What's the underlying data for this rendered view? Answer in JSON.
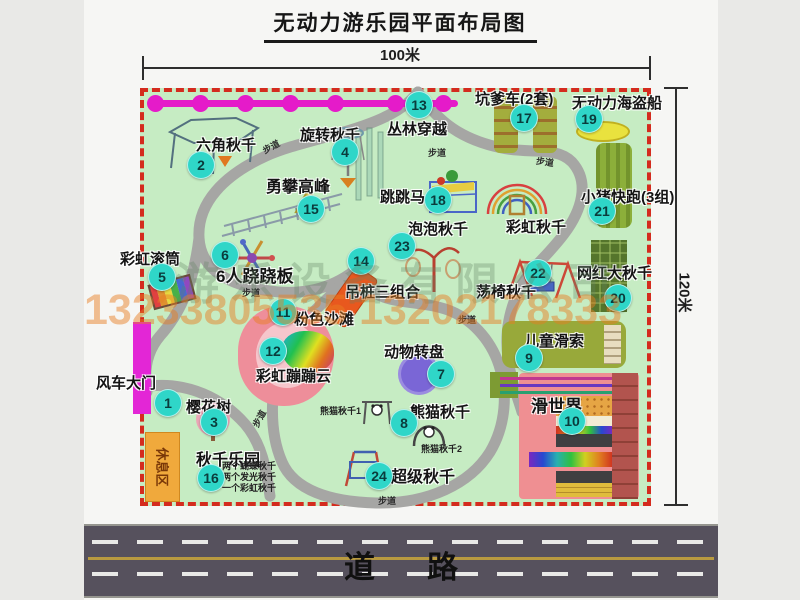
{
  "title": "无动力游乐园平面布局图",
  "dimensions": {
    "top": "100米",
    "right": "120米"
  },
  "road": {
    "label": "道路"
  },
  "watermark": {
    "company": "游乐设备有限公司",
    "phones": "13233805535 13202178333"
  },
  "park": {
    "rest_area_label": "休息区",
    "path_label": "步道",
    "rainbow_swing_label": "彩虹秋千",
    "panda_swing_1": "熊猫秋千1",
    "panda_swing_2": "熊猫秋千2",
    "swing_park_notes": [
      "两个蝴蝶秋千",
      "两个发光秋千",
      "一个彩虹秋千"
    ]
  },
  "items": [
    {
      "num": "1",
      "label": "风车大门"
    },
    {
      "num": "2",
      "label": "六角秋千"
    },
    {
      "num": "3",
      "label": "樱花树"
    },
    {
      "num": "4",
      "label": "旋转秋千"
    },
    {
      "num": "5",
      "label": "彩虹滚筒"
    },
    {
      "num": "6",
      "label": "6人跷跷板"
    },
    {
      "num": "7",
      "label": "动物转盘"
    },
    {
      "num": "8",
      "label": "熊猫秋千"
    },
    {
      "num": "9",
      "label": "儿童滑索"
    },
    {
      "num": "10",
      "label": "滑世界"
    },
    {
      "num": "11",
      "label": "粉色沙滩"
    },
    {
      "num": "12",
      "label": "彩虹蹦蹦云"
    },
    {
      "num": "13",
      "label": "丛林穿越"
    },
    {
      "num": "14",
      "label": "吊桩三组合"
    },
    {
      "num": "15",
      "label": "勇攀高峰"
    },
    {
      "num": "16",
      "label": "秋千乐园"
    },
    {
      "num": "17",
      "label": "坑爹车(2套)"
    },
    {
      "num": "18",
      "label": "跳跳马"
    },
    {
      "num": "19",
      "label": "无动力海盗船"
    },
    {
      "num": "20",
      "label": "网红大秋千"
    },
    {
      "num": "21",
      "label": "小猪快跑(3组)"
    },
    {
      "num": "22",
      "label": "荡椅秋千"
    },
    {
      "num": "23",
      "label": "泡泡秋千"
    },
    {
      "num": "24",
      "label": "超级秋千"
    }
  ],
  "colors": {
    "park_fill": "#c6ecc3",
    "border_red": "#d42b1e",
    "badge_teal": "#2fd6c8",
    "magenta_line": "#e51bc9",
    "road_gray": "#56515d",
    "gate_magenta": "#e326d6",
    "rest_orange": "#f0a93c"
  }
}
